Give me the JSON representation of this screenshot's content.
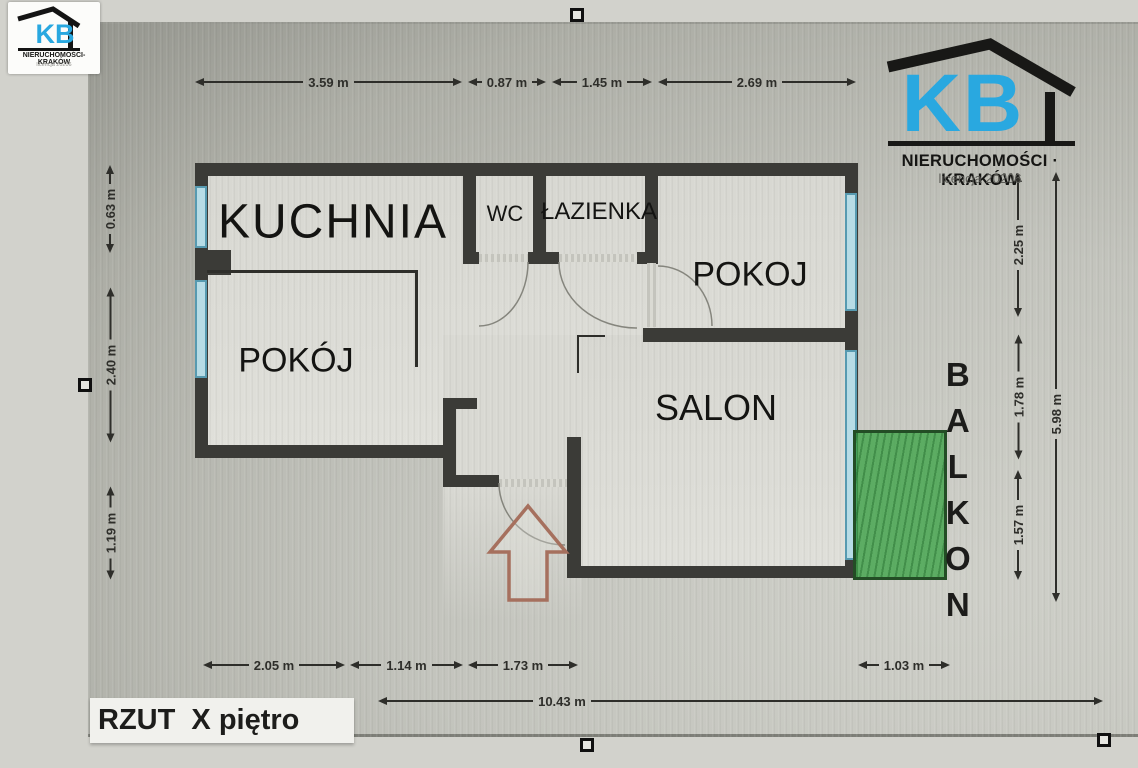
{
  "branding": {
    "logo_small": {
      "initials": "KB",
      "name": "NIERUCHOMOŚCI-KRAKÓW",
      "license": "licencja 20206"
    },
    "logo_large": {
      "initials": "KB",
      "name": "NIERUCHOMOŚCI · KRAKÓW",
      "license": "licencja 20206"
    }
  },
  "rooms": {
    "kitchen": "KUCHNIA",
    "wc": "WC",
    "bathroom": "ŁAZIENKA",
    "room_right": "POKOJ",
    "room_left": "POKÓJ",
    "living_room": "SALON",
    "balcony": "BALKON"
  },
  "dimensions": {
    "top": [
      {
        "label": "3.59 m"
      },
      {
        "label": "0.87 m"
      },
      {
        "label": "1.45 m"
      },
      {
        "label": "2.69 m"
      }
    ],
    "left": [
      {
        "label": "0.63 m"
      },
      {
        "label": "2.40 m"
      },
      {
        "label": "1.19 m"
      }
    ],
    "right": [
      {
        "label": "2.25 m"
      },
      {
        "label": "1.78 m"
      },
      {
        "label": "1.57 m"
      }
    ],
    "right_total": {
      "label": "5.98 m"
    },
    "bottom": [
      {
        "label": "2.05 m"
      },
      {
        "label": "1.14 m"
      },
      {
        "label": "1.73 m"
      },
      {
        "label": "1.03 m"
      }
    ],
    "bottom_total": {
      "label": "10.43 m"
    }
  },
  "caption": {
    "text": "RZUT  X piętro"
  },
  "colors": {
    "wall": "#3b3b37",
    "window_fill": "#b7dce6",
    "window_border": "#579ab0",
    "balcony_fill": "#3a9e42",
    "balcony_border": "#234d25",
    "entry_arrow": "#a6705e",
    "brand_blue": "#29a8e0"
  }
}
